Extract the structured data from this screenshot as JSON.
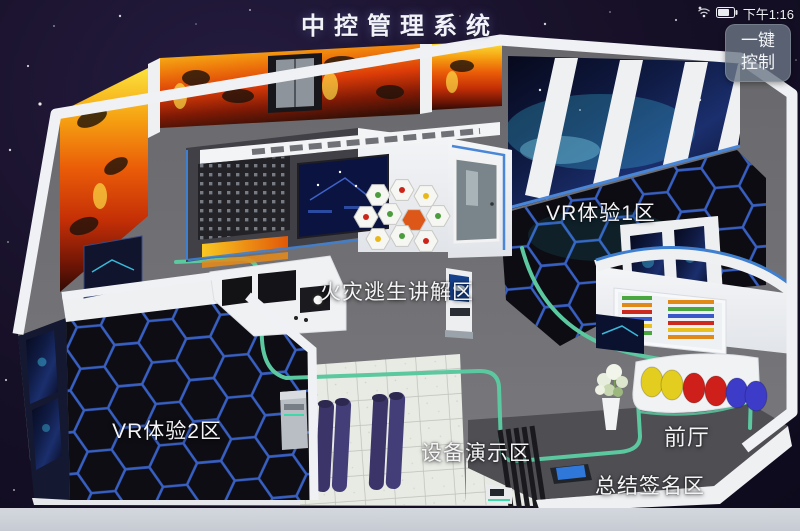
{
  "header": {
    "title": "中控管理系统",
    "status": {
      "time": "下午1:16"
    },
    "control_button": {
      "line1": "一键",
      "line2": "控制"
    }
  },
  "floorplan": {
    "zones": [
      {
        "id": "vr-zone-1",
        "label": "VR体验1区"
      },
      {
        "id": "fire-escape-explain",
        "label": "火灾逃生讲解区"
      },
      {
        "id": "vr-zone-2",
        "label": "VR体验2区"
      },
      {
        "id": "equipment-demo",
        "label": "设备演示区"
      },
      {
        "id": "front-hall",
        "label": "前厅"
      },
      {
        "id": "summary-signature",
        "label": "总结签名区"
      }
    ]
  },
  "colors": {
    "background": "#15112a",
    "path_line": "#5bc8a0",
    "hex_stroke": "#3a63cc",
    "accent_blue": "#3f7fd0",
    "fire_accent": "#e8540c"
  }
}
